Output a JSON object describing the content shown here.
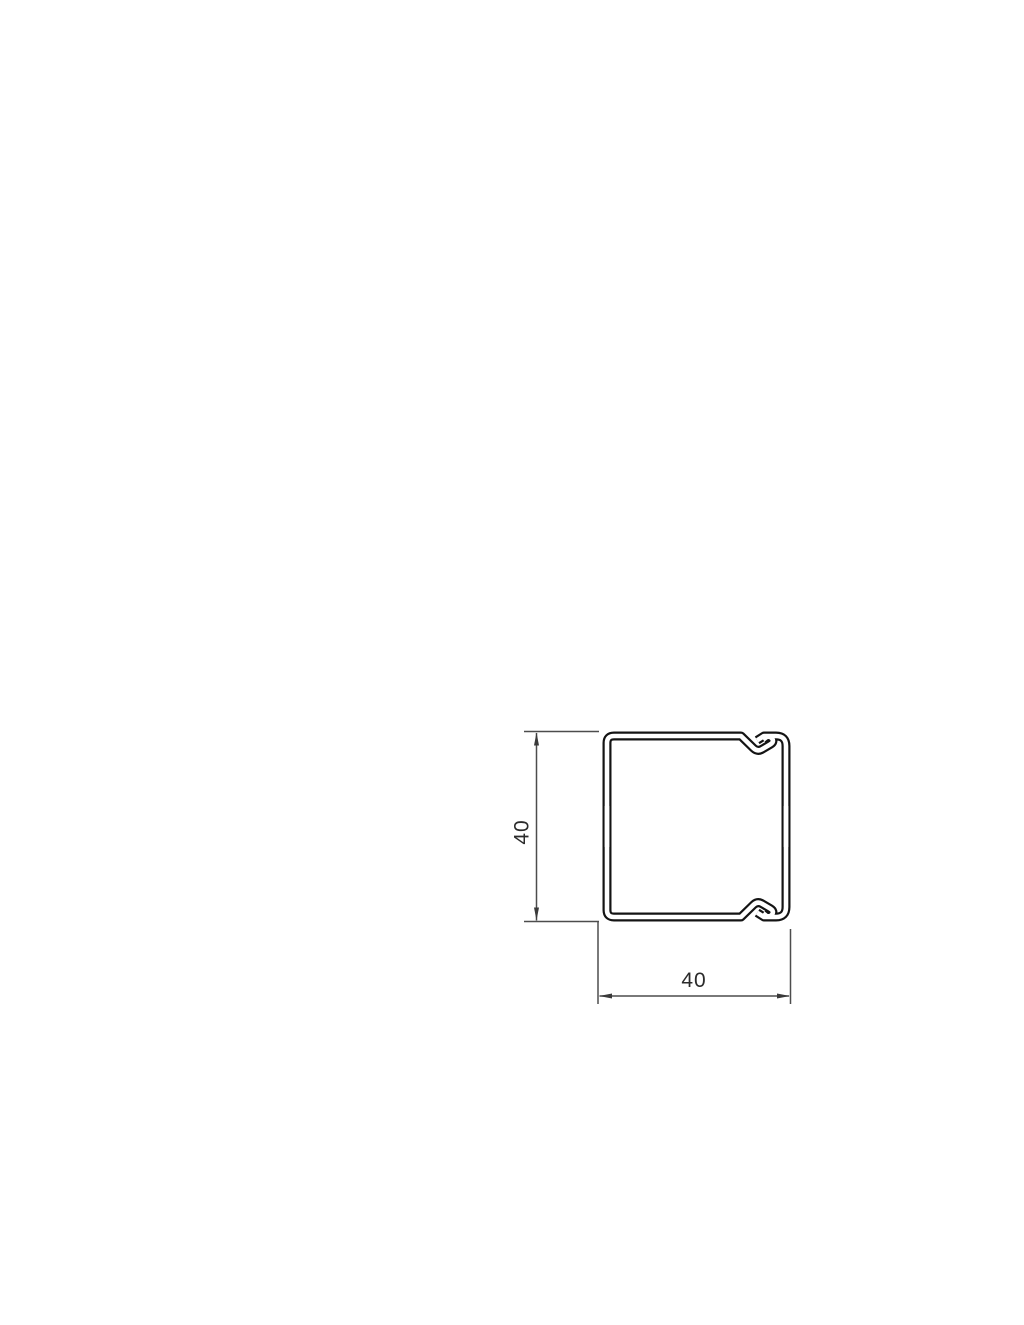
{
  "page": {
    "width_px": 1024,
    "height_px": 1325,
    "background_color": "#ffffff"
  },
  "drawing": {
    "kind": "technical cross-section line drawing",
    "subject": "square cable trunking (duct) profile with snap-latch lid on right side",
    "profile_line_color": "#141414",
    "dimension_line_color": "#4d4d4d",
    "text_color": "#2b2b2b",
    "dimensions": {
      "height": {
        "value": "40",
        "orientation": "vertical",
        "position": "left of profile"
      },
      "width": {
        "value": "40",
        "orientation": "horizontal",
        "position": "below profile"
      }
    }
  }
}
